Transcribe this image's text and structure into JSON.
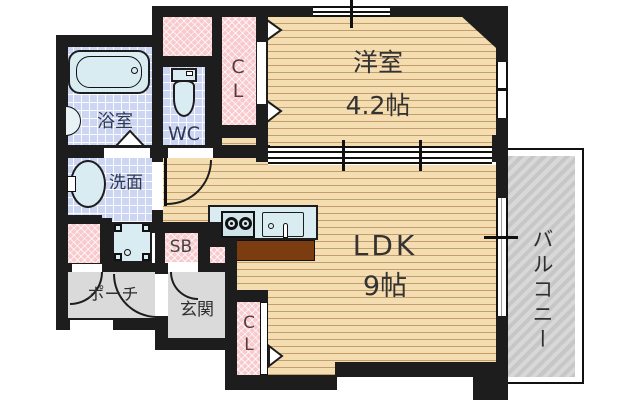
{
  "floorplan": {
    "title": "1LDK apartment floor plan",
    "rooms": {
      "western_room": {
        "label": "洋室",
        "size": "4.2帖"
      },
      "ldk": {
        "label": "LDK",
        "size": "9帖"
      },
      "balcony": {
        "label": "バルコニー"
      },
      "bathroom": {
        "label": "浴室"
      },
      "washroom": {
        "label": "洗面"
      },
      "toilet": {
        "label": "WC"
      },
      "closet_top": {
        "label": "CL"
      },
      "closet_bottom": {
        "label": "CL"
      },
      "shoe_box": {
        "label": "SB"
      },
      "porch": {
        "label": "ポーチ"
      },
      "entrance": {
        "label": "玄関"
      }
    },
    "colors": {
      "wall": "#1d1d1d",
      "wood_floor": "#f5ddb2",
      "tile": "#ccd5f2",
      "closet_pink": "#f8cacd",
      "fixture": "#d9ecf2",
      "gray_area": "#dadada",
      "balcony_hatch": "#c7c7c7",
      "kitchen_counter_brown": "#7b3d10",
      "closet_text": "#5c3a3a"
    }
  }
}
